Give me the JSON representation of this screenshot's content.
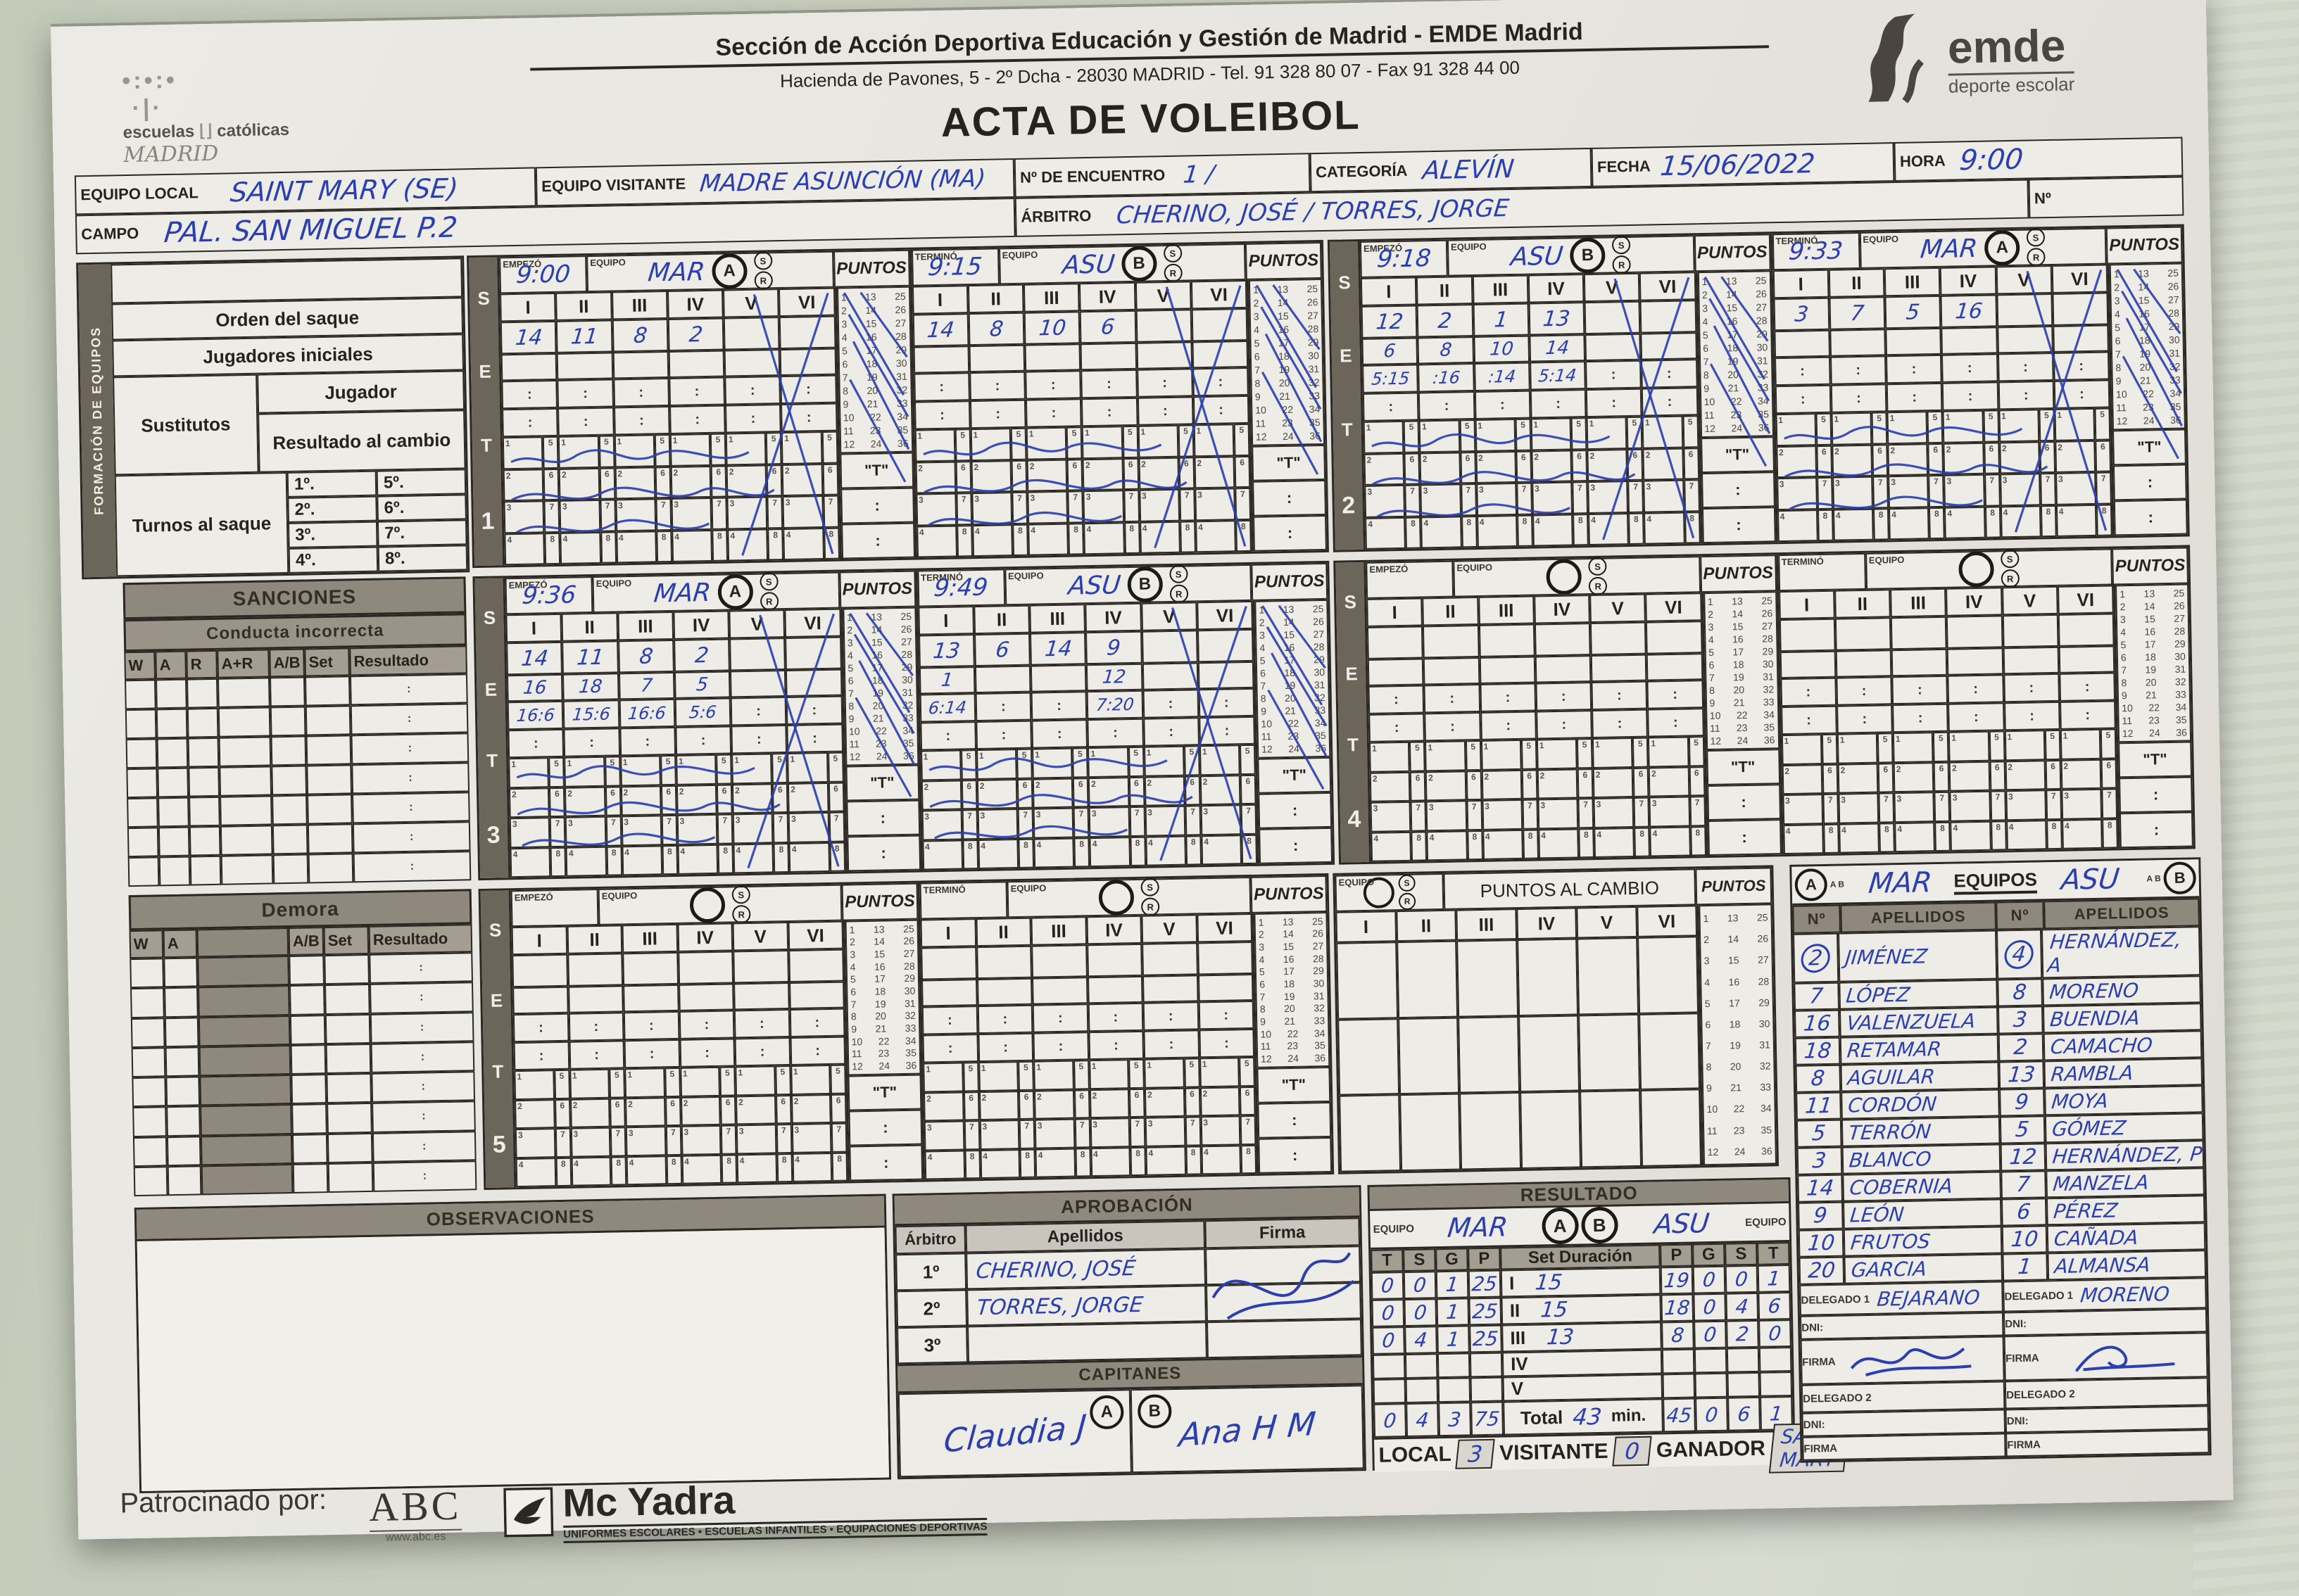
{
  "header": {
    "org1": "Sección de Acción Deportiva Educación y Gestión de Madrid - EMDE Madrid",
    "org2": "Hacienda de Pavones, 5 - 2º Dcha - 28030 MADRID - Tel. 91 328 80 07 - Fax 91 328 44 00",
    "title": "ACTA DE VOLEIBOL",
    "school": {
      "l1": "escuelas",
      "l2": "católicas",
      "l3": "MADRID"
    },
    "emde": {
      "name": "emde",
      "tagline": "deporte escolar"
    }
  },
  "info": {
    "equipo_local_label": "EQUIPO LOCAL",
    "equipo_local": "SAINT MARY (SE)",
    "equipo_visitante_label": "EQUIPO VISITANTE",
    "equipo_visitante": "MADRE ASUNCIÓN (MA)",
    "encuentro_label": "Nº DE ENCUENTRO",
    "encuentro": "1  /",
    "categoria_label": "CATEGORÍA",
    "categoria": "ALEVÍN",
    "fecha_label": "FECHA",
    "fecha": "15/06/2022",
    "hora_label": "HORA",
    "hora": "9:00",
    "campo_label": "CAMPO",
    "campo": "PAL. SAN MIGUEL P.2",
    "arbitro_label": "ÁRBITRO",
    "arbitro": "CHERINO, JOSÉ / TORRES, JORGE",
    "num_label": "Nº"
  },
  "formacion": {
    "title": "FORMACIÓN DE EQUIPOS",
    "orden": "Orden del saque",
    "jugadores": "Jugadores iniciales",
    "sustitutos": "Sustitutos",
    "jugador": "Jugador",
    "resultado_cambio": "Resultado al cambio",
    "turnos": "Turnos al saque",
    "turnos_nums": [
      "1º.",
      "5º.",
      "2º.",
      "6º.",
      "3º.",
      "7º.",
      "4º.",
      "8º."
    ]
  },
  "sanciones": {
    "title": "SANCIONES",
    "sub": "Conducta incorrecta",
    "cols": [
      "W",
      "A",
      "R",
      "A+R",
      "A/B",
      "Set",
      "Resultado"
    ],
    "row_count": 7
  },
  "demora": {
    "title": "Demora",
    "cols": [
      "W",
      "A",
      "A/B",
      "Set",
      "Resultado"
    ],
    "row_count": 8
  },
  "set_labels": {
    "set_letters": [
      "S",
      "E",
      "T"
    ],
    "empezo": "EMPEZÓ",
    "termino": "TERMINÓ",
    "equipo": "EQUIPO",
    "puntos": "PUNTOS",
    "cols": [
      "I",
      "II",
      "III",
      "IV",
      "V",
      "VI"
    ],
    "t_cell": "\"T\"",
    "colon": ":",
    "s_mark": "S",
    "r_mark": "R",
    "tally_row_nums": [
      "1",
      "2",
      "3",
      "4"
    ],
    "tally_col_nums": [
      "5",
      "6",
      "7",
      "8"
    ],
    "puntos_grid": [
      [
        1,
        13,
        25
      ],
      [
        2,
        14,
        26
      ],
      [
        3,
        15,
        27
      ],
      [
        4,
        16,
        28
      ],
      [
        5,
        17,
        29
      ],
      [
        6,
        18,
        30
      ],
      [
        7,
        19,
        31
      ],
      [
        8,
        20,
        32
      ],
      [
        9,
        21,
        33
      ],
      [
        10,
        22,
        34
      ],
      [
        11,
        23,
        35
      ],
      [
        12,
        24,
        36
      ]
    ]
  },
  "sets": [
    {
      "number": "1",
      "halves": [
        {
          "pos_label": "EMPEZÓ",
          "time": "9:00",
          "team": "MAR",
          "letter": "A",
          "used": true,
          "ini": [
            "14",
            "11",
            "8",
            "2",
            "",
            ""
          ],
          "row2": [
            "",
            "",
            "",
            "",
            "",
            ""
          ],
          "sub1": [
            "",
            "",
            "",
            "",
            "",
            ""
          ]
        },
        {
          "pos_label": "TERMINÓ",
          "time": "9:15",
          "team": "ASU",
          "letter": "B",
          "used": true,
          "ini": [
            "14",
            "8",
            "10",
            "6",
            "",
            ""
          ],
          "row2": [
            "",
            "",
            "",
            "",
            "",
            ""
          ],
          "sub1": [
            "",
            "",
            "",
            "",
            "",
            ""
          ]
        }
      ]
    },
    {
      "number": "2",
      "halves": [
        {
          "pos_label": "EMPEZÓ",
          "time": "9:18",
          "team": "ASU",
          "letter": "B",
          "used": true,
          "ini": [
            "12",
            "2",
            "1",
            "13",
            "",
            ""
          ],
          "row2": [
            "6",
            "8",
            "10",
            "14",
            "",
            ""
          ],
          "sub1": [
            "5:15",
            ":16",
            ":14",
            "5:14",
            "",
            ""
          ]
        },
        {
          "pos_label": "TERMINÓ",
          "time": "9:33",
          "team": "MAR",
          "letter": "A",
          "used": true,
          "ini": [
            "3",
            "7",
            "5",
            "16",
            "",
            ""
          ],
          "row2": [
            "",
            "",
            "",
            "",
            "",
            ""
          ],
          "sub1": [
            "",
            "",
            "",
            "",
            "",
            ""
          ]
        }
      ]
    },
    {
      "number": "3",
      "halves": [
        {
          "pos_label": "EMPEZÓ",
          "time": "9:36",
          "team": "MAR",
          "letter": "A",
          "used": true,
          "ini": [
            "14",
            "11",
            "8",
            "2",
            "",
            ""
          ],
          "row2": [
            "16",
            "18",
            "7",
            "5",
            "",
            ""
          ],
          "sub1": [
            "16:6",
            "15:6",
            "16:6",
            "5:6",
            "",
            ""
          ]
        },
        {
          "pos_label": "TERMINÓ",
          "time": "9:49",
          "team": "ASU",
          "letter": "B",
          "used": true,
          "ini": [
            "13",
            "6",
            "14",
            "9",
            "",
            ""
          ],
          "row2": [
            "1",
            "",
            "",
            "12",
            "",
            ""
          ],
          "sub1": [
            "6:14",
            "",
            "",
            "7:20",
            "",
            ""
          ]
        }
      ]
    },
    {
      "number": "4",
      "halves": [
        {
          "pos_label": "EMPEZÓ",
          "time": "",
          "team": "",
          "letter": "",
          "used": false,
          "ini": [
            "",
            "",
            "",
            "",
            "",
            ""
          ],
          "row2": [
            "",
            "",
            "",
            "",
            "",
            ""
          ],
          "sub1": [
            "",
            "",
            "",
            "",
            "",
            ""
          ]
        },
        {
          "pos_label": "TERMINÓ",
          "time": "",
          "team": "",
          "letter": "",
          "used": false,
          "ini": [
            "",
            "",
            "",
            "",
            "",
            ""
          ],
          "row2": [
            "",
            "",
            "",
            "",
            "",
            ""
          ],
          "sub1": [
            "",
            "",
            "",
            "",
            "",
            ""
          ]
        }
      ]
    },
    {
      "number": "5",
      "halves": [
        {
          "pos_label": "EMPEZÓ",
          "time": "",
          "team": "",
          "letter": "",
          "used": false,
          "ini": [
            "",
            "",
            "",
            "",
            "",
            ""
          ],
          "row2": [
            "",
            "",
            "",
            "",
            "",
            ""
          ],
          "sub1": [
            "",
            "",
            "",
            "",
            "",
            ""
          ]
        },
        {
          "pos_label": "TERMINÓ",
          "time": "",
          "team": "",
          "letter": "",
          "used": false,
          "ini": [
            "",
            "",
            "",
            "",
            "",
            ""
          ],
          "row2": [
            "",
            "",
            "",
            "",
            "",
            ""
          ],
          "sub1": [
            "",
            "",
            "",
            "",
            "",
            ""
          ]
        }
      ]
    }
  ],
  "cambio": {
    "equipo_label": "EQUIPO",
    "title": "PUNTOS AL CAMBIO",
    "puntos": "PUNTOS",
    "empty_rows": 3
  },
  "equipos": {
    "title": "EQUIPOS",
    "ab_small": "A B",
    "left_letter": "A",
    "left_team": "MAR",
    "right_letter": "B",
    "right_team": "ASU",
    "col_num": "Nº",
    "col_name": "APELLIDOS",
    "mar": [
      {
        "n": "2",
        "name": "JIMÉNEZ",
        "circled": true
      },
      {
        "n": "7",
        "name": "LÓPEZ",
        "circled": false
      },
      {
        "n": "16",
        "name": "VALENZUELA",
        "circled": false
      },
      {
        "n": "18",
        "name": "RETAMAR",
        "circled": false
      },
      {
        "n": "8",
        "name": "AGUILAR",
        "circled": false
      },
      {
        "n": "11",
        "name": "CORDÓN",
        "circled": false
      },
      {
        "n": "5",
        "name": "TERRÓN",
        "circled": false
      },
      {
        "n": "3",
        "name": "BLANCO",
        "circled": false
      },
      {
        "n": "14",
        "name": "COBERNIA",
        "circled": false
      },
      {
        "n": "9",
        "name": "LEÓN",
        "circled": false
      },
      {
        "n": "10",
        "name": "FRUTOS",
        "circled": false
      },
      {
        "n": "20",
        "name": "GARCIA",
        "circled": false
      }
    ],
    "asu": [
      {
        "n": "4",
        "name": "HERNÁNDEZ, A",
        "circled": true
      },
      {
        "n": "8",
        "name": "MORENO",
        "circled": false
      },
      {
        "n": "3",
        "name": "BUENDIA",
        "circled": false
      },
      {
        "n": "2",
        "name": "CAMACHO",
        "circled": false
      },
      {
        "n": "13",
        "name": "RAMBLA",
        "circled": false
      },
      {
        "n": "9",
        "name": "MOYA",
        "circled": false
      },
      {
        "n": "5",
        "name": "GÓMEZ",
        "circled": false
      },
      {
        "n": "12",
        "name": "HERNÁNDEZ, P",
        "circled": false
      },
      {
        "n": "7",
        "name": "MANZELA",
        "circled": false
      },
      {
        "n": "6",
        "name": "PÉREZ",
        "circled": false
      },
      {
        "n": "10",
        "name": "CAÑADA",
        "circled": false
      },
      {
        "n": "1",
        "name": "ALMANSA",
        "circled": false
      }
    ],
    "delegado1_label": "DELEGADO 1",
    "delegado2_label": "DELEGADO 2",
    "dni_label": "DNI:",
    "firma_label": "FIRMA",
    "mar_delegado1": "BEJARANO",
    "asu_delegado1": "MORENO"
  },
  "observaciones": {
    "title": "OBSERVACIONES"
  },
  "aprobacion": {
    "title": "APROBACIÓN",
    "arbitro": "Árbitro",
    "apellidos": "Apellidos",
    "firma": "Firma",
    "rows": [
      {
        "n": "1º",
        "name": "CHERINO, JOSÉ"
      },
      {
        "n": "2º",
        "name": "TORRES, JORGE"
      },
      {
        "n": "3º",
        "name": ""
      }
    ],
    "capitanes": "CAPITANES",
    "cap_a": "A",
    "cap_b": "B",
    "cap_a_sig": "Claudia J",
    "cap_b_sig": "Ana H M"
  },
  "resultado": {
    "title": "RESULTADO",
    "equipo_label": "EQUIPO",
    "left_team": "MAR",
    "letter_a": "A",
    "letter_b": "B",
    "right_team": "ASU",
    "cols_left": [
      "T",
      "S",
      "G",
      "P"
    ],
    "set_duracion": "Set Duración",
    "cols_right": [
      "P",
      "G",
      "S",
      "T"
    ],
    "rows": [
      {
        "set": "I",
        "left": [
          "0",
          "0",
          "1",
          "25"
        ],
        "dur": "15",
        "right": [
          "19",
          "0",
          "0",
          "1"
        ]
      },
      {
        "set": "II",
        "left": [
          "0",
          "0",
          "1",
          "25"
        ],
        "dur": "15",
        "right": [
          "18",
          "0",
          "4",
          "6"
        ]
      },
      {
        "set": "III",
        "left": [
          "0",
          "4",
          "1",
          "25"
        ],
        "dur": "13",
        "right": [
          "8",
          "0",
          "2",
          "0"
        ]
      },
      {
        "set": "IV",
        "left": [
          "",
          "",
          "",
          ""
        ],
        "dur": "",
        "right": [
          "",
          "",
          "",
          ""
        ]
      },
      {
        "set": "V",
        "left": [
          "",
          "",
          "",
          ""
        ],
        "dur": "",
        "right": [
          "",
          "",
          "",
          ""
        ]
      }
    ],
    "total_label": "Total",
    "total_left": [
      "0",
      "4",
      "3",
      "75"
    ],
    "total_dur": "43",
    "min_label": "min.",
    "total_right": [
      "45",
      "0",
      "6",
      "1"
    ],
    "local_label": "LOCAL",
    "local": "3",
    "visitante_label": "VISITANTE",
    "visitante": "0",
    "ganador_label": "GANADOR",
    "ganador": "SAINT MARY"
  },
  "footer": {
    "patrocinado": "Patrocinado por:",
    "abc": "ABC",
    "abc_url": "www.abc.es",
    "mcyadra": "Mc Yadra",
    "tagline": "UNIFORMES ESCOLARES • ESCUELAS INFANTILES • EQUIPACIONES DEPORTIVAS"
  },
  "colors": {
    "handwriting": "#2b3fae",
    "band": "#8f887c",
    "paper": "#e9e7e1",
    "line": "#2b2823"
  }
}
